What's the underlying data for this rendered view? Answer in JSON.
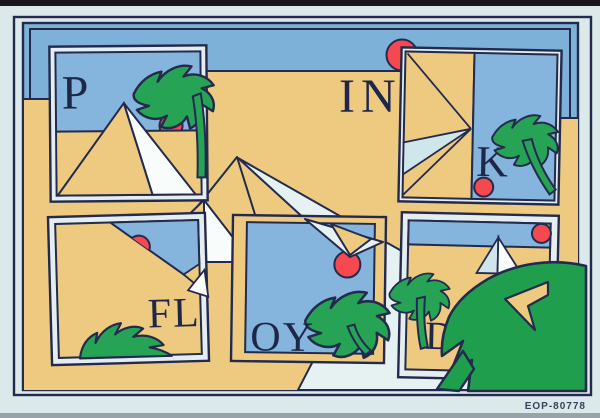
{
  "artwork": {
    "panel_letters": {
      "p": "P",
      "in": "IN",
      "k": "K",
      "fl": "FL",
      "oy": "OY",
      "d": "D"
    },
    "print_code": "EOP-80778",
    "colors": {
      "bg": "#dce9ea",
      "mat": "#e4eef0",
      "sky": "#7db1d8",
      "panel-sky": "#85b4dc",
      "sand": "#eeca81",
      "green": "#27a355",
      "leaf-green": "#1f9f4d",
      "red": "#f6484f",
      "outline": "#232a4d",
      "band": "#e6f1f2",
      "pyramid-white": "#f8fcfb",
      "pyramid-shadow": "#cfe4eb",
      "pale-wedge": "#cfe6ec",
      "letter": "#1e2747",
      "code-text": "#39415c",
      "photo-edge-top": "#17171c",
      "photo-edge-bottom": "#97a3a9"
    }
  }
}
